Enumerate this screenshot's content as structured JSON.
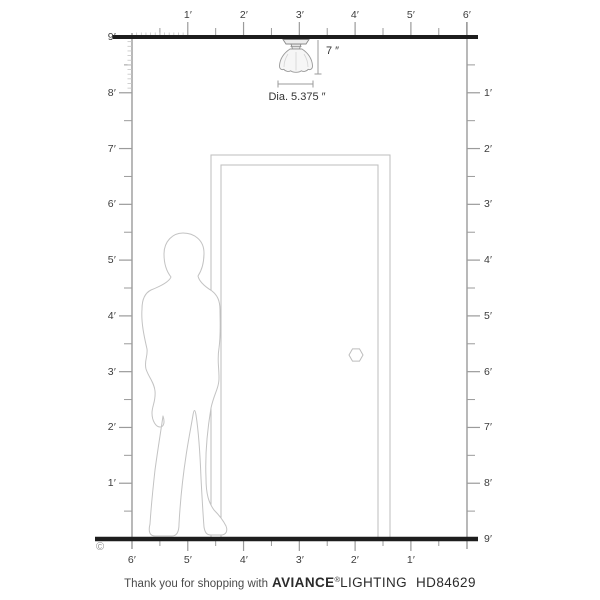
{
  "diagram": {
    "copyright_symbol": "©",
    "fixture": {
      "height_label": "7 ″",
      "diameter_label": "Dia. 5.375 ″"
    }
  },
  "rulers": {
    "top": [
      "1′",
      "2′",
      "3′",
      "4′",
      "5′",
      "6′"
    ],
    "bottom": [
      "6′",
      "5′",
      "4′",
      "3′",
      "2′",
      "1′"
    ],
    "left": [
      "9′",
      "8′",
      "7′",
      "6′",
      "5′",
      "4′",
      "3′",
      "2′",
      "1′"
    ],
    "right": [
      "1′",
      "2′",
      "3′",
      "4′",
      "5′",
      "6′",
      "7′",
      "8′",
      "9′"
    ]
  },
  "footer": {
    "message": "Thank you for shopping with",
    "brand_primary": "AVIANCE",
    "registered_mark": "®",
    "brand_secondary": "LIGHTING",
    "model_number": "HD84629"
  },
  "colors": {
    "structure_line": "#1d1d1d",
    "ruler_line": "#9b9b9b",
    "sketch_outline": "#c3c3c3",
    "label_text": "#3c3c3c"
  }
}
